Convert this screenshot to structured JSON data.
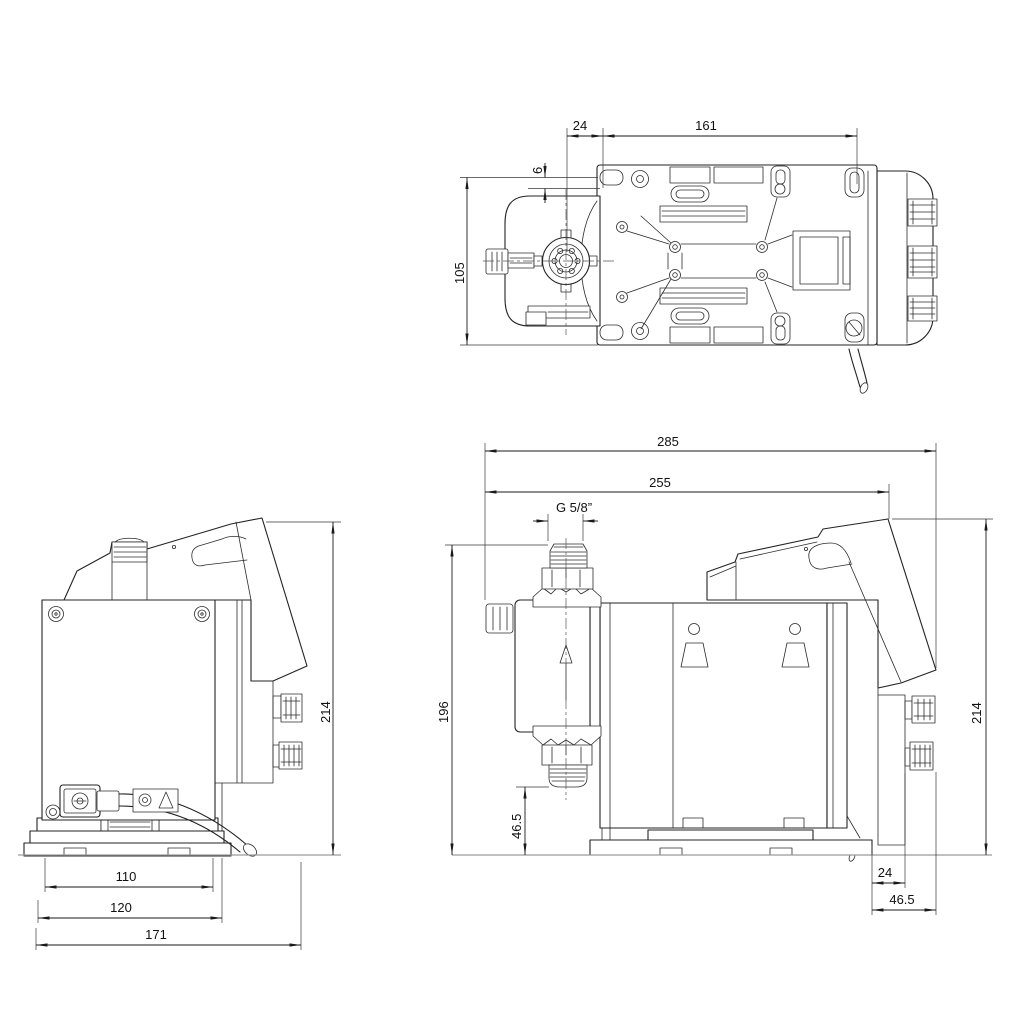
{
  "colors": {
    "background": "#ffffff",
    "outline": "#232323",
    "dimension_line": "#1a1a1a",
    "ground_line": "#9b9b9b"
  },
  "dimensions": {
    "top_view": {
      "hole_offset_x": "24",
      "hole_spacing": "161",
      "hole_offset_y": "6",
      "plate_width": "105"
    },
    "front_view": {
      "foot_width": "110",
      "base_width": "120",
      "overall_depth": "171",
      "overall_height": "214"
    },
    "side_view": {
      "overall_length": "285",
      "mounting_length": "255",
      "thread_size": "G 5/8”",
      "inlet_height": "196",
      "outlet_to_base": "46.5",
      "overall_height": "214",
      "back_offset": "24",
      "back_depth": "46.5"
    }
  }
}
